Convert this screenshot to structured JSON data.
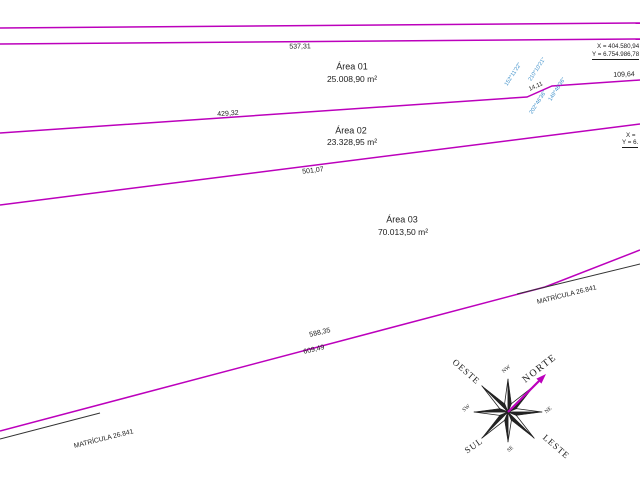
{
  "areas": [
    {
      "title": "Área 01",
      "area": "25.008,90 m²"
    },
    {
      "title": "Área 02",
      "area": "23.328,95 m²"
    },
    {
      "title": "Área 03",
      "area": "70.013,50 m²"
    }
  ],
  "measurements": {
    "seg_537": "537,31",
    "seg_429": "429,32",
    "seg_14": "14,11",
    "seg_109": "109,64",
    "seg_501": "501,07",
    "seg_588": "588,35",
    "seg_609": "609,49"
  },
  "angles": {
    "a1": "152°11'22\"",
    "a2": "210°10'21\"",
    "a3": "149°46'36\"",
    "a4": "202°46'36\""
  },
  "coordinates": {
    "top_x": "X = 404.580,94",
    "top_y": "Y = 6.754.986,78",
    "right_x": "X =",
    "right_y": "Y = 6."
  },
  "matricula": {
    "left": "MATRÍCULA 26.841",
    "right": "MATRÍCULA 26.841"
  },
  "compass": {
    "north": "NORTE",
    "west": "OESTE",
    "south": "SUL",
    "east": "LESTE",
    "nw": "NW",
    "ne": "NE",
    "sw": "SW",
    "se": "SE"
  },
  "colors": {
    "boundary_magenta": "#bc00bc",
    "matricula_black": "#333333",
    "angle_blue": "#3b8ec9",
    "text_black": "#1c1c1c"
  }
}
